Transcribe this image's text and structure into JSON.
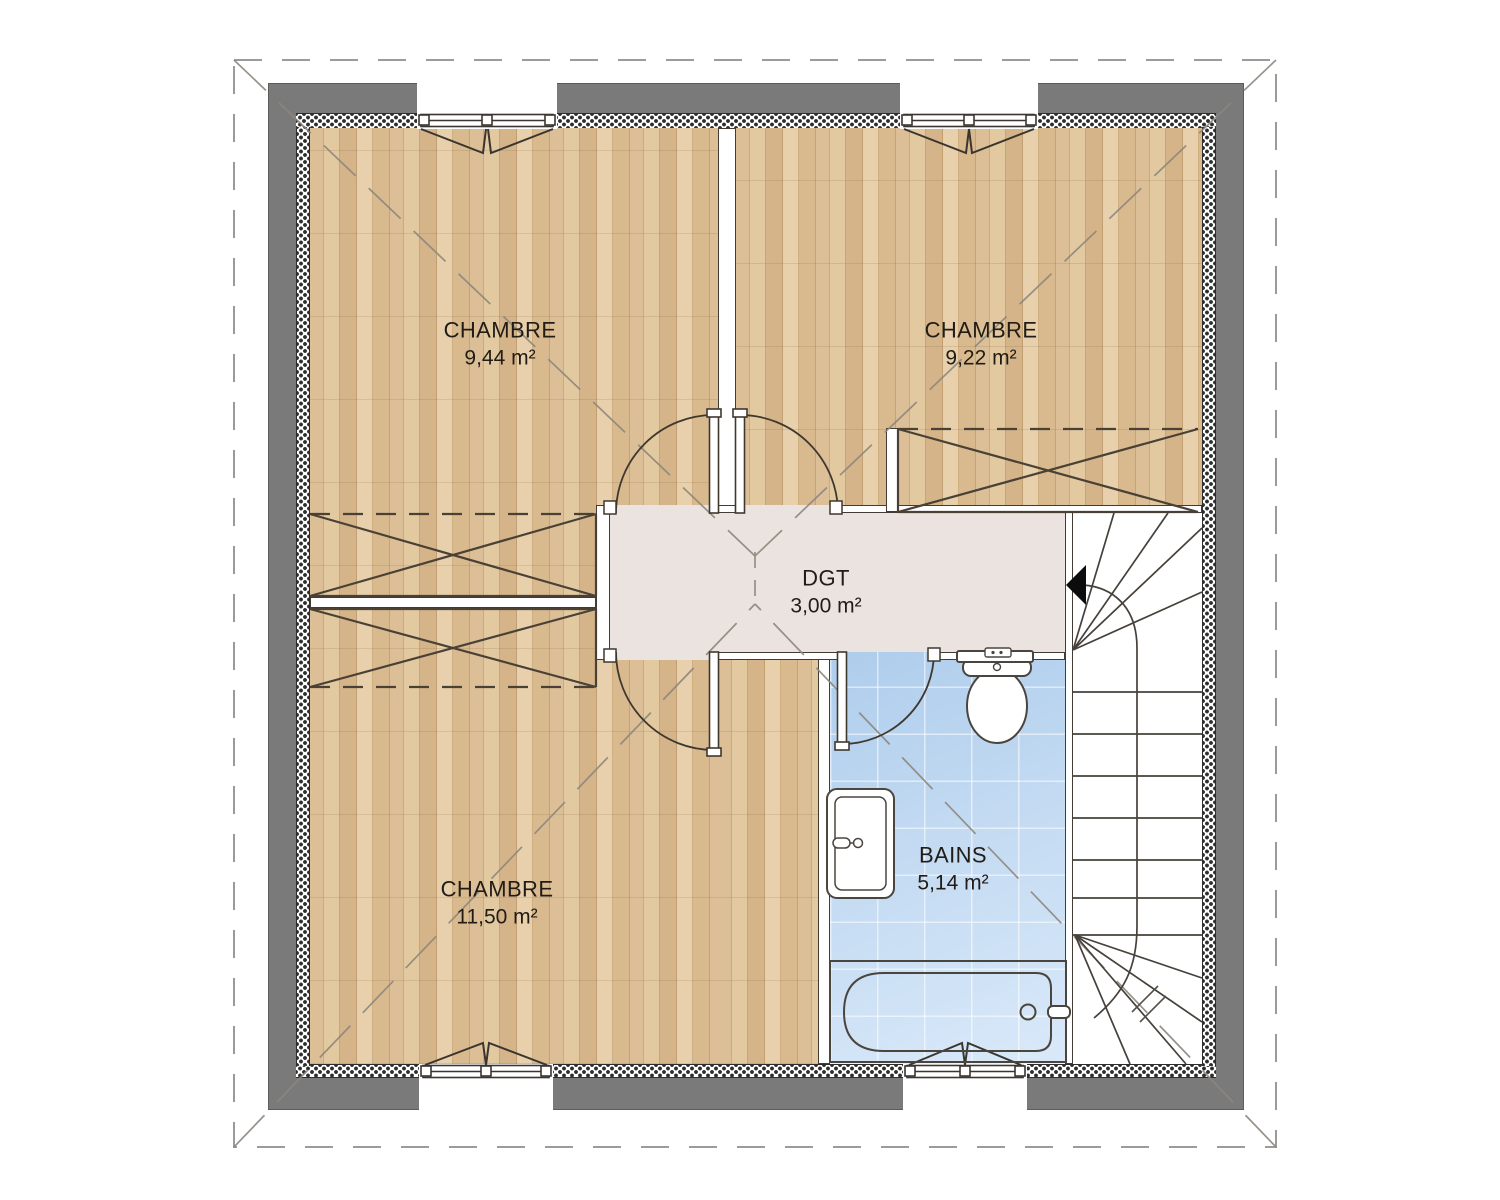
{
  "rooms": [
    {
      "name": "CHAMBRE",
      "area": "9,44 m²"
    },
    {
      "name": "CHAMBRE",
      "area": "9,22 m²"
    },
    {
      "name": "DGT",
      "area": "3,00 m²"
    },
    {
      "name": "CHAMBRE",
      "area": "11,50 m²"
    },
    {
      "name": "BAINS",
      "area": "5,14 m²"
    }
  ],
  "colors": {
    "exterior_wall": "#7a7a7a",
    "wood_floor": "#d6b68a",
    "hall_floor": "#eae3df",
    "bath_floor": "#bdd6ef",
    "linework": "#3f382f"
  }
}
